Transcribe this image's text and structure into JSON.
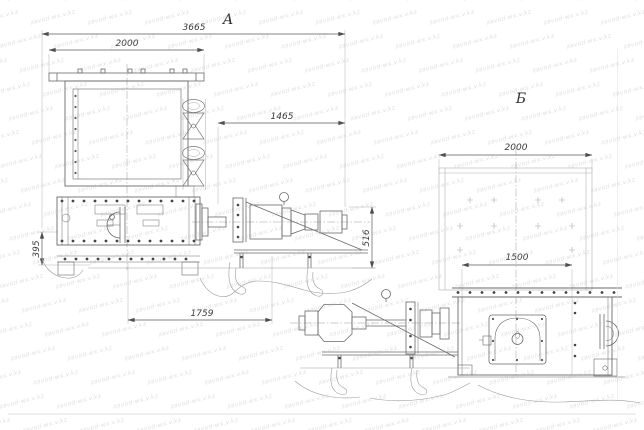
{
  "drawing": {
    "view_a": {
      "label": "А",
      "dim_overall_length": "3665",
      "dim_cover_width": "2000",
      "dim_drive_length": "1465",
      "dim_height_left": "395",
      "dim_height_right": "516",
      "dim_base_length": "1759"
    },
    "view_b": {
      "label": "Б",
      "dim_body_width": "2000",
      "dim_base_width": "1500"
    },
    "watermark_text": "zavod-wx.v.kz"
  }
}
